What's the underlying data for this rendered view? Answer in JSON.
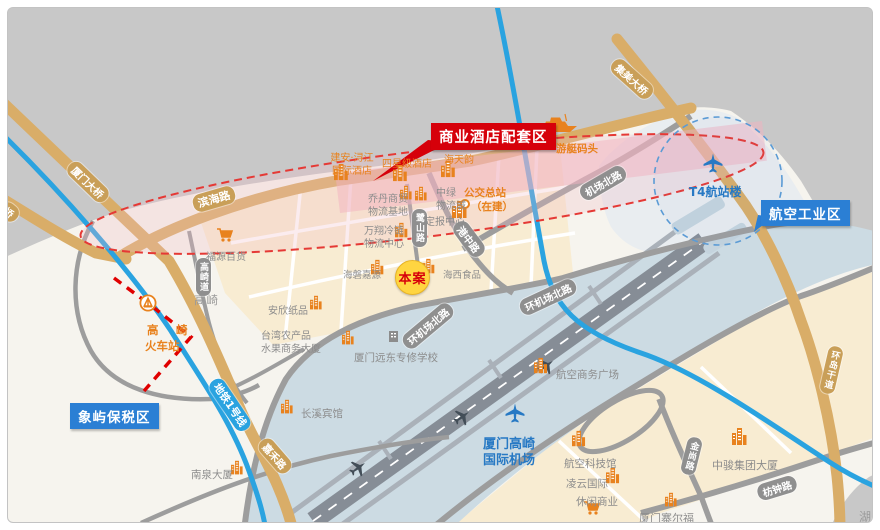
{
  "map": {
    "callouts": {
      "hotel_zone": "商业酒店配套区",
      "aviation_zone": "航空工业区",
      "bonded_zone": "象屿保税区"
    },
    "site": {
      "label": "本案"
    },
    "airport": {
      "line1": "厦门高崎",
      "line2": "国际机场",
      "t4": "T4航站楼"
    },
    "station": {
      "char1": "高",
      "char2": "崎",
      "line2": "火车站"
    },
    "areas": {
      "gaoqi": "高崎",
      "lake": "湖"
    },
    "roads": {
      "xiamen_bridge": "厦门大桥",
      "bridge_stub": "桥",
      "binhai": "滨海路",
      "jimei_bridge": "集美大桥",
      "jichang_north": "机场北路",
      "huan_jichang_1": "环机场北路",
      "huan_jichang_2": "环机场北路",
      "gangzhong": "港中路",
      "lushan": "鹭山路",
      "gaoqidao": "高崎道",
      "metro1": "地铁1号线",
      "jiahe": "嘉禾路",
      "fangzhong": "枋钟路",
      "jinshang": "金尚路",
      "huandao": "环岛干道"
    },
    "pois": {
      "jian_an_l1": "建安·浔江",
      "jian_an_l2": "国际酒店",
      "four_star": "四星级酒店",
      "haitianyun": "海天韵",
      "yacht": "游艇码头",
      "bus_l1": "公交总站",
      "bus_l2": "（在建）",
      "qiaodan_l1": "乔丹商贸",
      "qiaodan_l2": "物流基地",
      "zhonglv_l1": "中绿",
      "zhonglv_l2": "物流城",
      "wanxiang_l1": "万翔冷链",
      "wanxiang_l2": "物流中心",
      "dingbao": "定报中心",
      "fuyuan": "福源百货",
      "anxin": "安欣纸品",
      "haipan": "海磐嘉源",
      "haixi": "海西食品",
      "taiwan_l1": "台湾农产品",
      "taiwan_l2": "水果商务大厦",
      "yuandong": "厦门远东专修学校",
      "changxi": "长溪宾馆",
      "nanquan": "南泉大厦",
      "hangkong_plaza": "航空商务广场",
      "keji": "航空科技馆",
      "lingyun": "凌云国际",
      "xiuxian": "休闲商业",
      "zhongjun": "中骏集团大厦",
      "zhaier": "厦门寨尔福"
    },
    "colors": {
      "callout_red": "#d6000a",
      "label_blue": "#2b7fd4",
      "poi_orange": "#e8821e",
      "site_yellow": "#ffd541",
      "metro_blue": "#2aa3e0",
      "road_tan": "#d9ad68"
    }
  }
}
